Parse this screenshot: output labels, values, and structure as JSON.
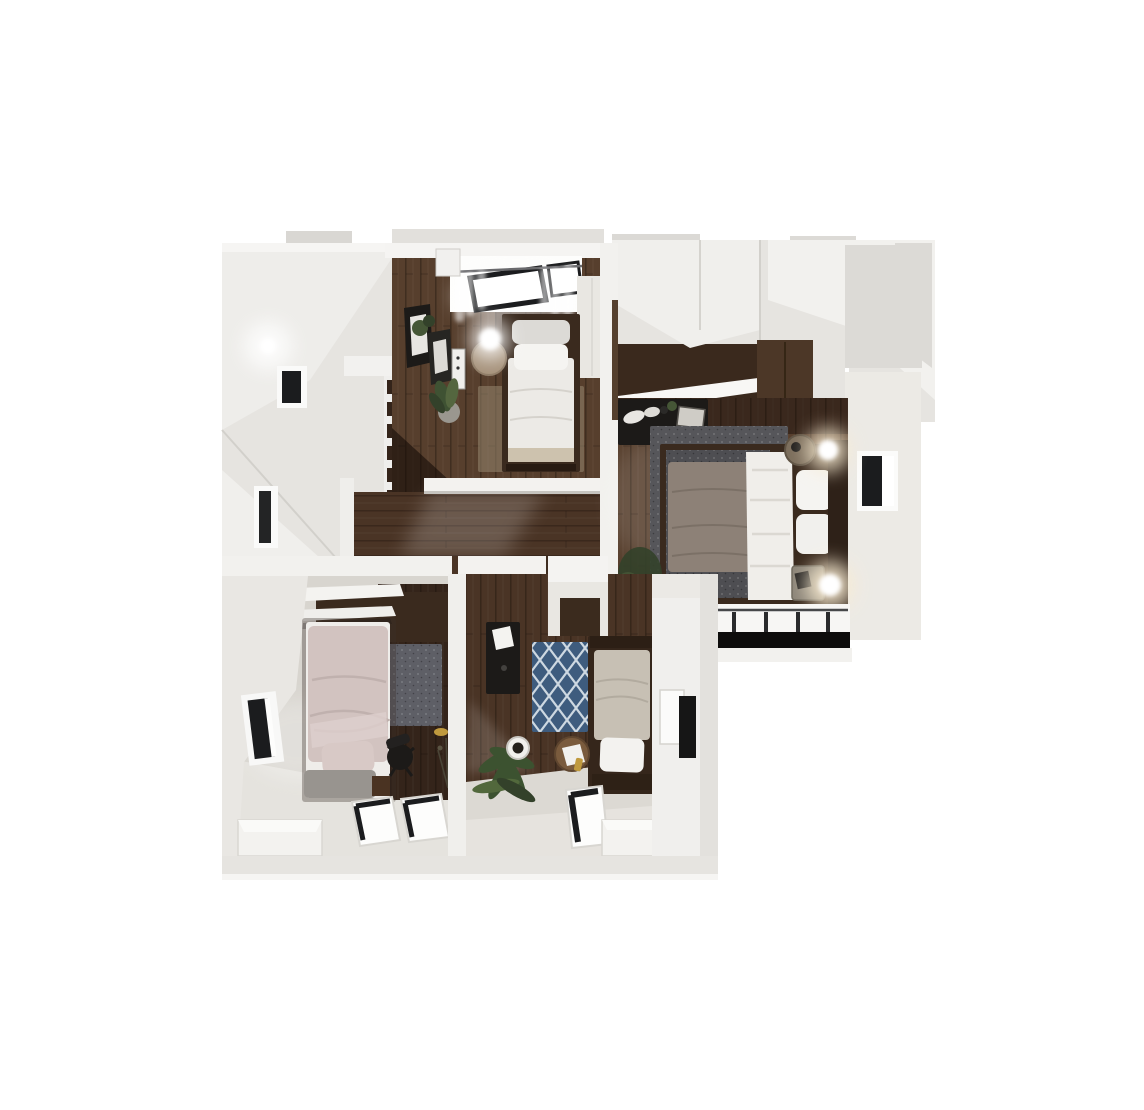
{
  "meta": {
    "kind": "3d-floorplan-render",
    "description": "Top-down 3D dollhouse rendering of an upper apartment floor with three small bedrooms, a master bedroom, central hallway and staircase on a white background",
    "canvas": {
      "width": 1144,
      "height": 1110
    }
  },
  "palette": {
    "background": "#ffffff",
    "wall_bright": "#f6f5f3",
    "wall_light": "#efeeeb",
    "wall_mid": "#e6e4e0",
    "wall_grey": "#d9d7d3",
    "wall_shadow": "#c4c2bd",
    "wood_dark": "#34241a",
    "wood_mid": "#573f2d",
    "wood_warm": "#6a4c36",
    "wood_hall": "#4a3425",
    "carpet": "#d8d5cf",
    "carpet_bright": "#e7e4df",
    "rug_beige": "#96866f",
    "rug_grey": "#56565a",
    "rug_slate": "#5e5f66",
    "rug_blue": "#3e5c7e",
    "rug_blue_line": "#cdd8e1",
    "bed_white": "#eceae6",
    "pillow_white": "#f5f4f1",
    "blanket_taupe": "#8d8177",
    "blanket_khaki": "#cdc2ae",
    "duvet_pink": "#d2c3c0",
    "duvet_greige": "#c7c0b4",
    "bench_grey": "#98948f",
    "headboard_brown": "#3a2a1e",
    "furniture_black": "#1c1a18",
    "wardrobe_brown": "#4c3727",
    "plant_green": "#455636",
    "plant_dark": "#33412a",
    "frame_black": "#1b1c1e",
    "glow_warm": "#f9ecd2",
    "white_glow": "#ffffff",
    "box_white": "#f3f2ef",
    "gold": "#c09a3e"
  },
  "rooms": [
    {
      "id": "stairwell-hall",
      "position": "top-left",
      "features": [
        "tall white walls",
        "wall lamp",
        "small window",
        "tall narrow window",
        "dark wood staircase treads"
      ]
    },
    {
      "id": "bedroom-top",
      "position": "top-center",
      "features": [
        "dark wood floor",
        "single bed with white duvet and two pillows",
        "beige area rug",
        "skylight window with curtain rod and sheer curtains",
        "wardrobe",
        "leaning picture frames on desk",
        "snake plant",
        "round jute side table with glowing lamp"
      ]
    },
    {
      "id": "master-bedroom",
      "position": "right",
      "features": [
        "dark wood floor",
        "double bed with white duvet, taupe blanket and brown headboard",
        "speckled grey rug",
        "black dresser with decor",
        "two nightstands with lit lamps",
        "window on right wall",
        "window band with railing at bottom",
        "walk-in closet with white shelving and brown wardrobes",
        "corner plant"
      ]
    },
    {
      "id": "bedroom-bottom-left",
      "position": "bottom-left",
      "features": [
        "light carpet",
        "single bed with blush pink duvet and grey bench cushion",
        "dark wood desk nook with slate rug",
        "black office chair",
        "white wall shelves",
        "window on left wall",
        "two floor skylights",
        "white storage box",
        "twig plant with gold vase"
      ]
    },
    {
      "id": "bedroom-bottom-center",
      "position": "bottom-center",
      "features": [
        "dark wood and carpet floor",
        "single bed with greige duvet and white pillow",
        "blue trellis rug",
        "black desk with white paper",
        "palm plant",
        "white round planter",
        "wooden stool with gold bottle",
        "floor skylight",
        "white storage box",
        "white closet vestibule",
        "framed panel and dark panel on right wall"
      ]
    }
  ]
}
